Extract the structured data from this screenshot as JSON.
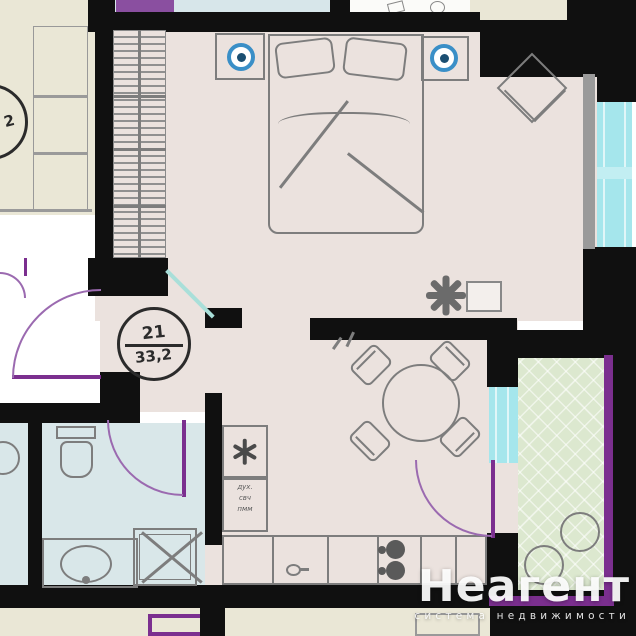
{
  "plan": {
    "unit_label": {
      "number": "21",
      "area": "33,2"
    },
    "neighbor_label": {
      "number": "2"
    },
    "kitchen_annotation": {
      "lines": [
        "дух.",
        "свч",
        "пмм"
      ]
    },
    "watermark": {
      "title": "Неагент",
      "subtitle": "система недвижимости"
    },
    "icons": [
      "wardrobe-hangers-icon",
      "double-bed-icon",
      "nightstand-lamp-icon",
      "armchair-diamond-icon",
      "plant-icon",
      "dining-table-icon",
      "chair-icon",
      "fridge-asterisk-icon",
      "stove-burners-icon",
      "kitchen-sink-icon",
      "toilet-icon",
      "bath-sink-icon",
      "shower-icon",
      "door-swing-icon",
      "window-icon",
      "balcony-stool-icon"
    ],
    "colors": {
      "wall": "#101010",
      "unit_fill": "#ebe2de",
      "bathroom_fill": "#d9e7e9",
      "neighbor_fill": "#eae7d6",
      "balcony_fill": "#dce8cf",
      "window_glass": "#a5e6ec",
      "door_accent": "#7b2f8f",
      "furniture_line": "#7d7d7d",
      "lamp_blue": "#3a8fc7",
      "watermark_text": "#ffffff"
    }
  }
}
